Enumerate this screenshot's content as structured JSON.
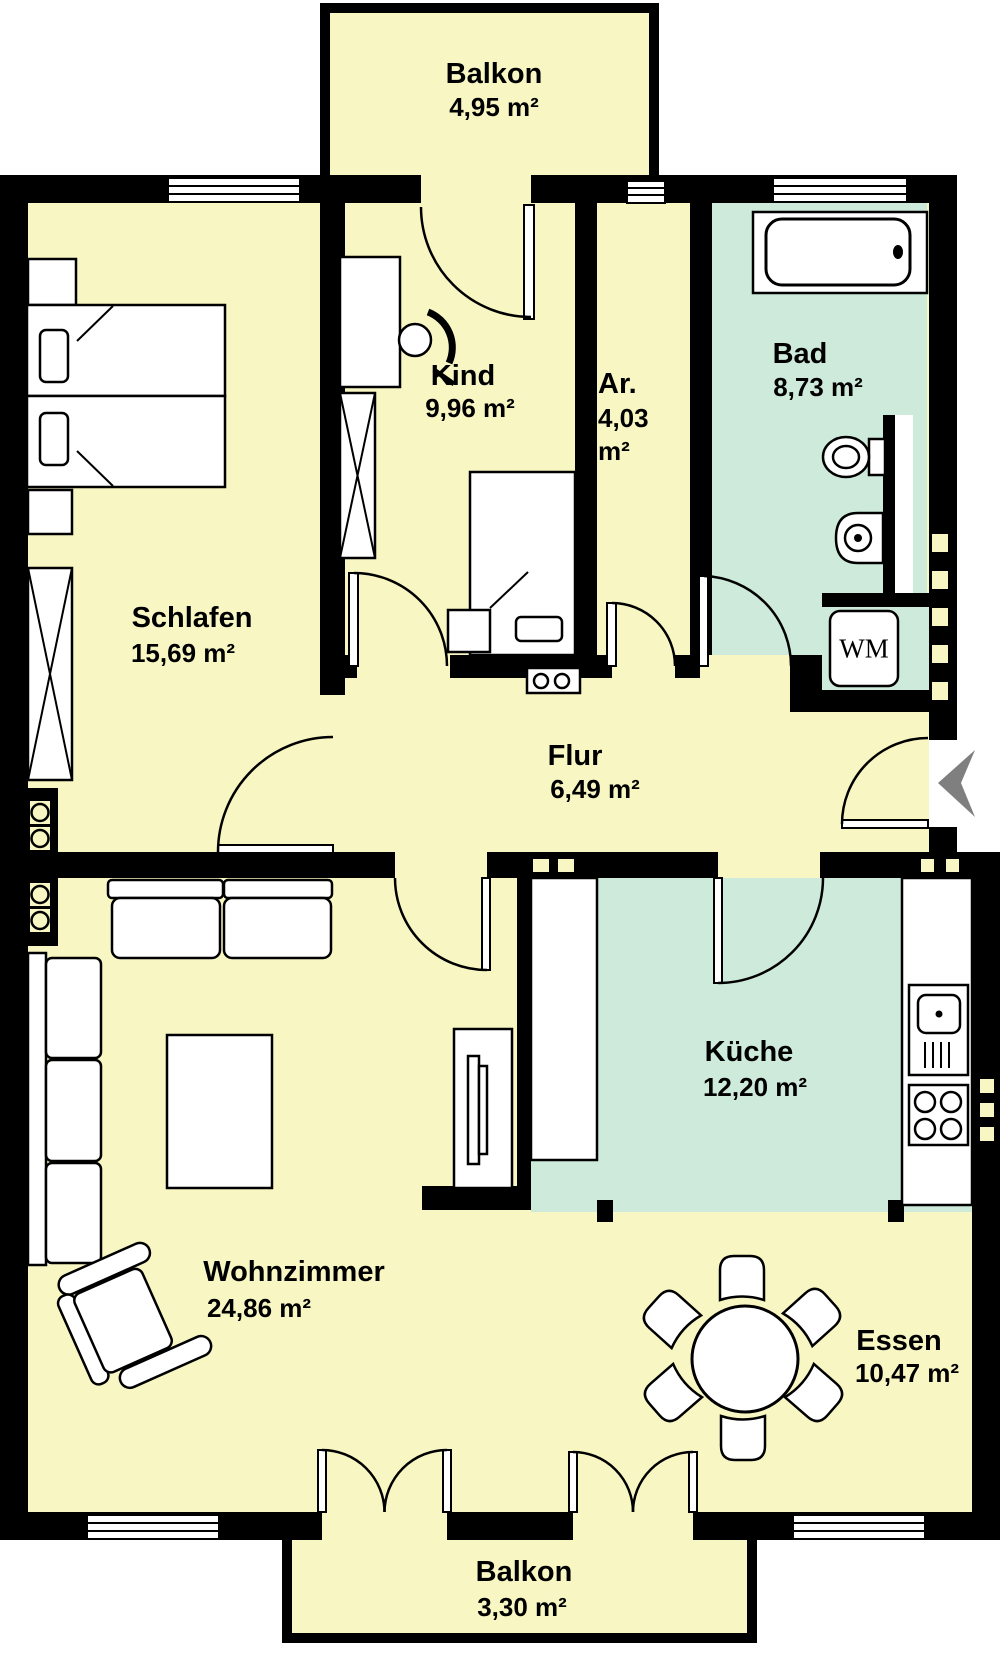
{
  "floorplan": {
    "colors": {
      "wall": "#000000",
      "room_yellow": "#F8F7C3",
      "room_teal": "#CDEADA",
      "outside": "#FFFFFF",
      "entrance_arrow": "#7F7F7F"
    },
    "rooms": {
      "balkon_top": {
        "name": "Balkon",
        "area": "4,95 m²"
      },
      "schlafen": {
        "name": "Schlafen",
        "area": "15,69 m²"
      },
      "kind": {
        "name": "Kind",
        "area": "9,96 m²"
      },
      "abstellraum": {
        "name": "Ar.",
        "area": "4,03 m²"
      },
      "bad": {
        "name": "Bad",
        "area": "8,73 m²"
      },
      "flur": {
        "name": "Flur",
        "area": "6,49 m²"
      },
      "kueche": {
        "name": "Küche",
        "area": "12,20 m²"
      },
      "wohnzimmer": {
        "name": "Wohnzimmer",
        "area": "24,86 m²"
      },
      "essen": {
        "name": "Essen",
        "area": "10,47 m²"
      },
      "balkon_bottom": {
        "name": "Balkon",
        "area": "3,30 m²"
      }
    },
    "appliances": {
      "washing_machine_label": "WM"
    }
  }
}
